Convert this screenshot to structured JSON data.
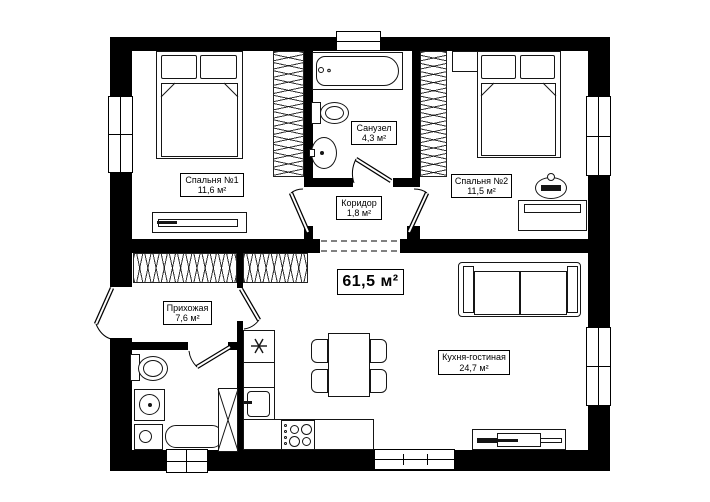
{
  "plan": {
    "total_area": "61,5 м²",
    "rooms": {
      "bedroom1": {
        "name": "Спальня №1",
        "area": "11,6 м²"
      },
      "bathroom": {
        "name": "Санузел",
        "area": "4,3 м²"
      },
      "bedroom2": {
        "name": "Спальня №2",
        "area": "11,5 м²"
      },
      "corridor": {
        "name": "Коридор",
        "area": "1,8 м²"
      },
      "hallway": {
        "name": "Прихожая",
        "area": "7,6 м²"
      },
      "kitchen": {
        "name": "Кухня-гостиная",
        "area": "24,7 м²"
      }
    },
    "colors": {
      "wall": "#000000",
      "line": "#151515",
      "background": "#ffffff"
    }
  }
}
